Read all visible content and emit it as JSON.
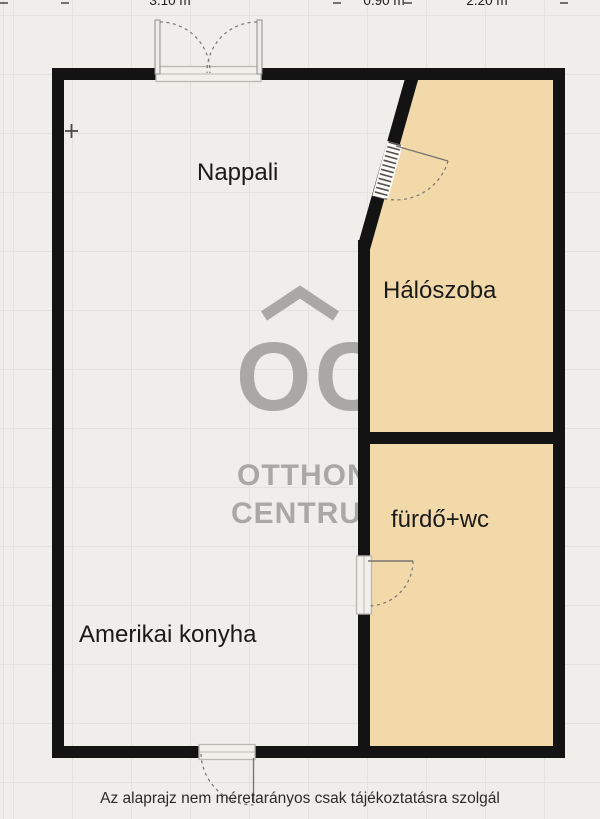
{
  "plan": {
    "rooms": [
      {
        "id": "nappali",
        "label": "Nappali"
      },
      {
        "id": "haloszoba",
        "label": "Hálószoba"
      },
      {
        "id": "furdo_wc",
        "label": "fürdő+wc"
      },
      {
        "id": "amerikai_konyha",
        "label": "Amerikai konyha"
      }
    ],
    "dimensions_top": [
      {
        "value": "3.10 m"
      },
      {
        "value": "0.90 m"
      },
      {
        "value": "2.20 m"
      }
    ],
    "caption": "Az alaprajz nem méretarányos csak tájékoztatásra szolgál",
    "watermark": {
      "monogram": "OC",
      "name_line1": "OTTHON",
      "name_line2": "CENTRUM"
    },
    "colors": {
      "background": "#f0eeea",
      "wall": "#131313",
      "room_fill": "#f2d9aa",
      "watermark": "#a9a8a4",
      "door_line": "#777470",
      "sill_stroke": "#b9b7b2"
    }
  }
}
